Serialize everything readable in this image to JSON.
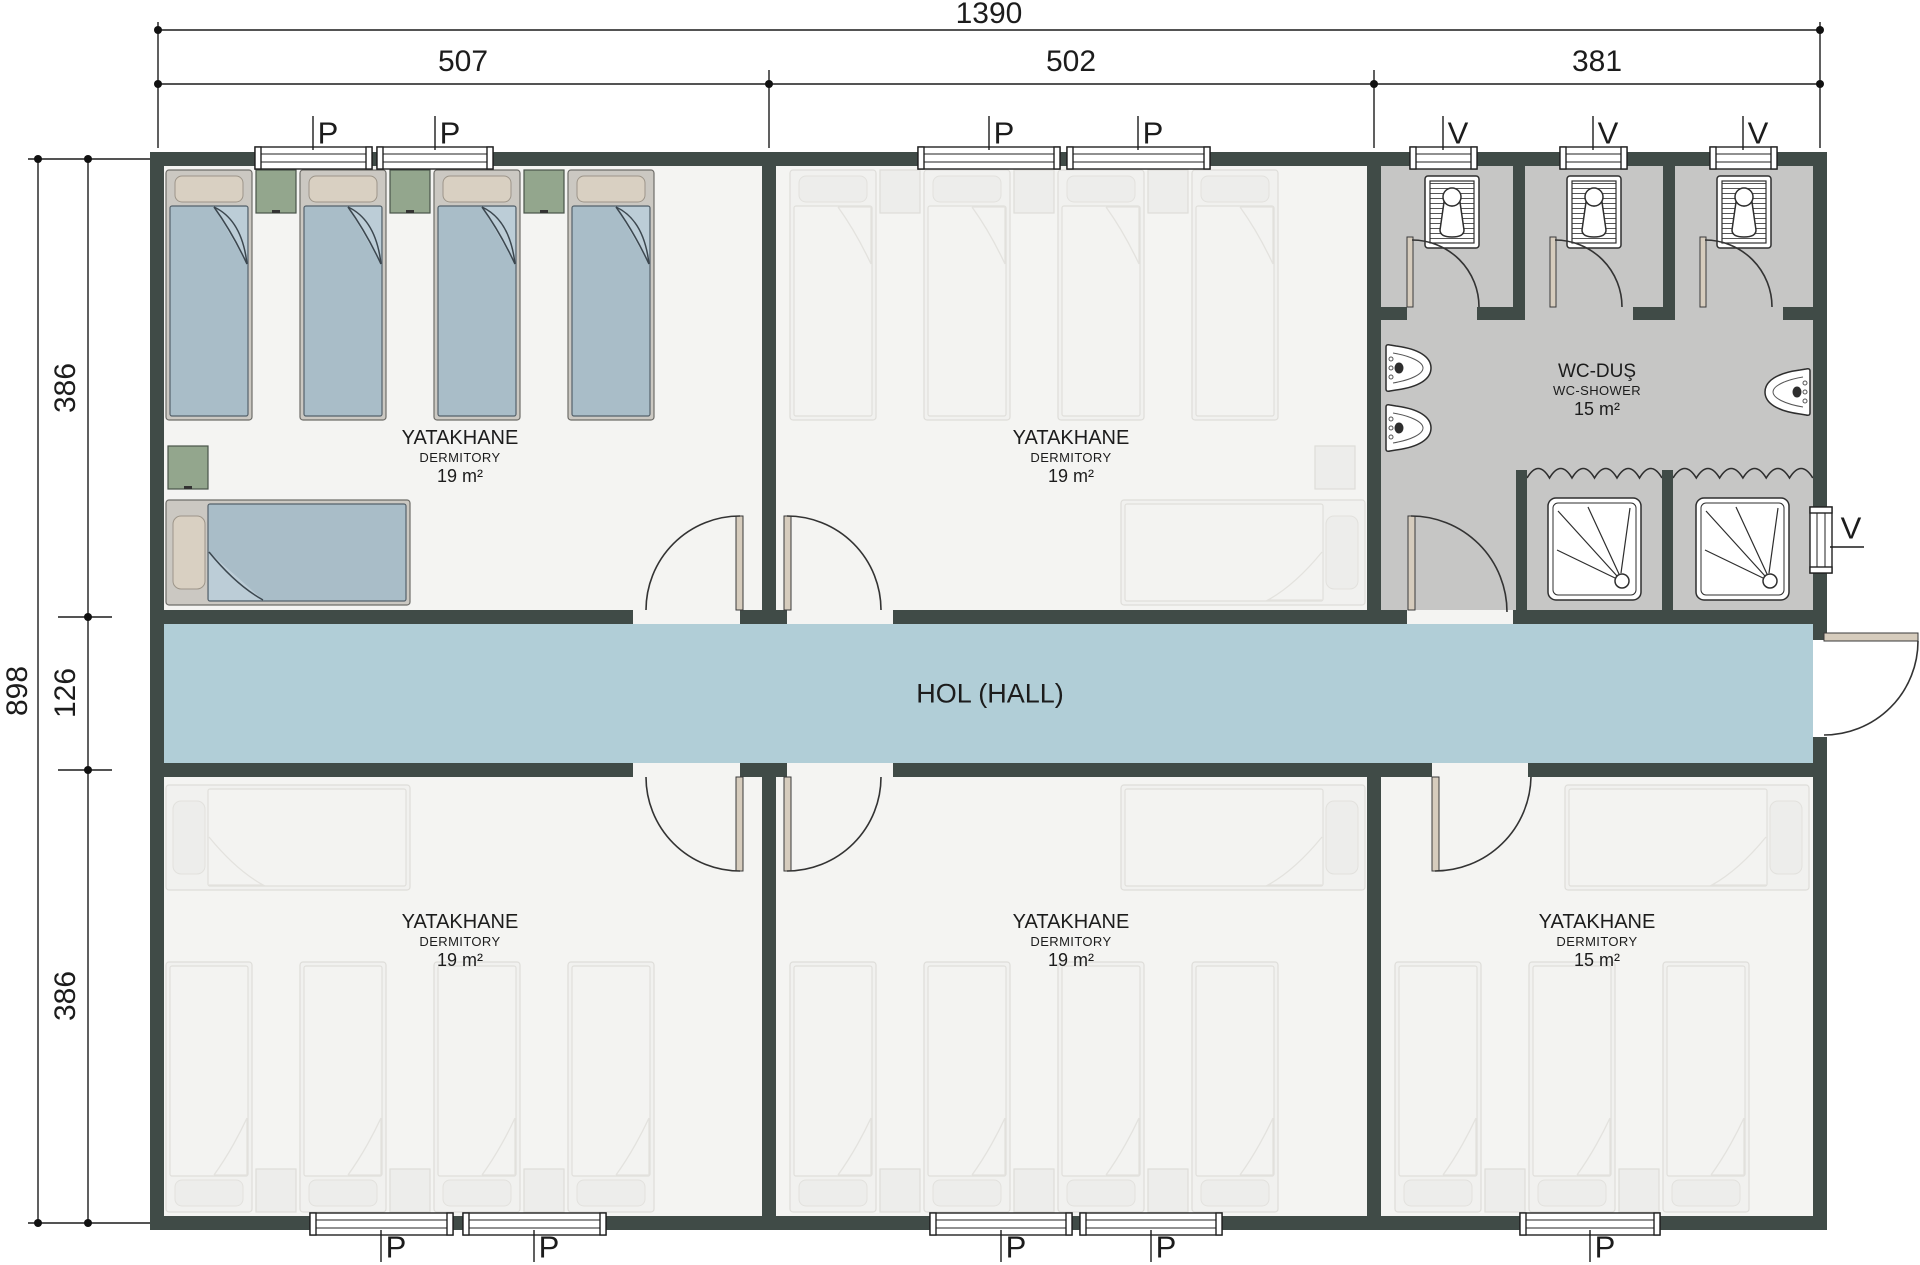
{
  "colors": {
    "wall": "#404b47",
    "floor": "#f4f4f2",
    "hall": "#b1ced7",
    "wc-floor": "#c6c6c5",
    "blanket": "#a9bdc8",
    "pillow": "#d9d0c2",
    "bed-frame": "#cbc8c2",
    "nightstand": "#93a68d",
    "door-leaf": "#d6ccbd",
    "ink": "#1c1c1c"
  },
  "dimensions": {
    "width_total": "1390",
    "width_segments": [
      "507",
      "502",
      "381"
    ],
    "height_total": "898",
    "height_segments": [
      "386",
      "126",
      "386"
    ]
  },
  "rooms": [
    {
      "name": "YATAKHANE",
      "type": "DERMITORY",
      "area": "19 m²"
    },
    {
      "name": "YATAKHANE",
      "type": "DERMITORY",
      "area": "19 m²"
    },
    {
      "name": "WC-DUŞ",
      "type": "WC-SHOWER",
      "area": "15 m²"
    },
    {
      "name": "YATAKHANE",
      "type": "DERMITORY",
      "area": "19 m²"
    },
    {
      "name": "YATAKHANE",
      "type": "DERMITORY",
      "area": "19 m²"
    },
    {
      "name": "YATAKHANE",
      "type": "DERMITORY",
      "area": "15 m²"
    }
  ],
  "hall": {
    "label": "HOL (HALL)"
  },
  "window_labels": {
    "top": [
      "P",
      "P",
      "P",
      "P",
      "V",
      "V",
      "V"
    ],
    "bottom": [
      "P",
      "P",
      "P",
      "P",
      "P"
    ],
    "right": [
      "V"
    ]
  }
}
